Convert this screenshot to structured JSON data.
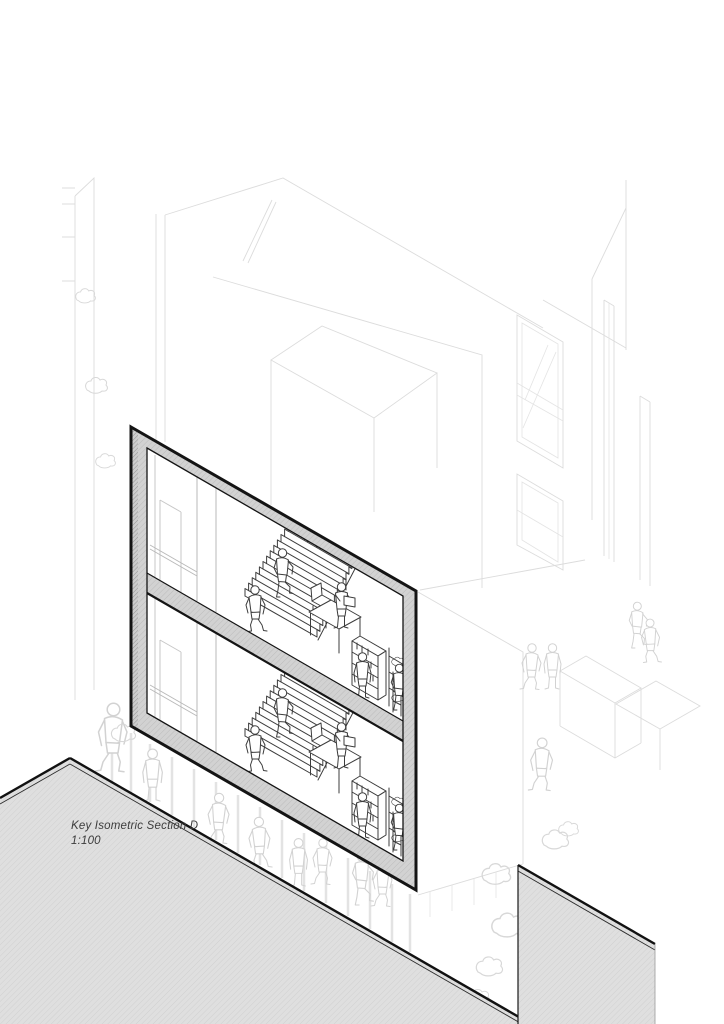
{
  "drawing": {
    "title": "Key Isometric Section D",
    "scale": "1:100"
  },
  "palette": {
    "paper": "#ffffff",
    "cut_line": "#141414",
    "cut_poche_fill": "#d2d2d2",
    "ground_plane_fill": "#dfdfdf",
    "interior_line": "#3d3d3d",
    "context_ghost_line": "#d7d7d7",
    "label_color": "#3c3c3c"
  }
}
